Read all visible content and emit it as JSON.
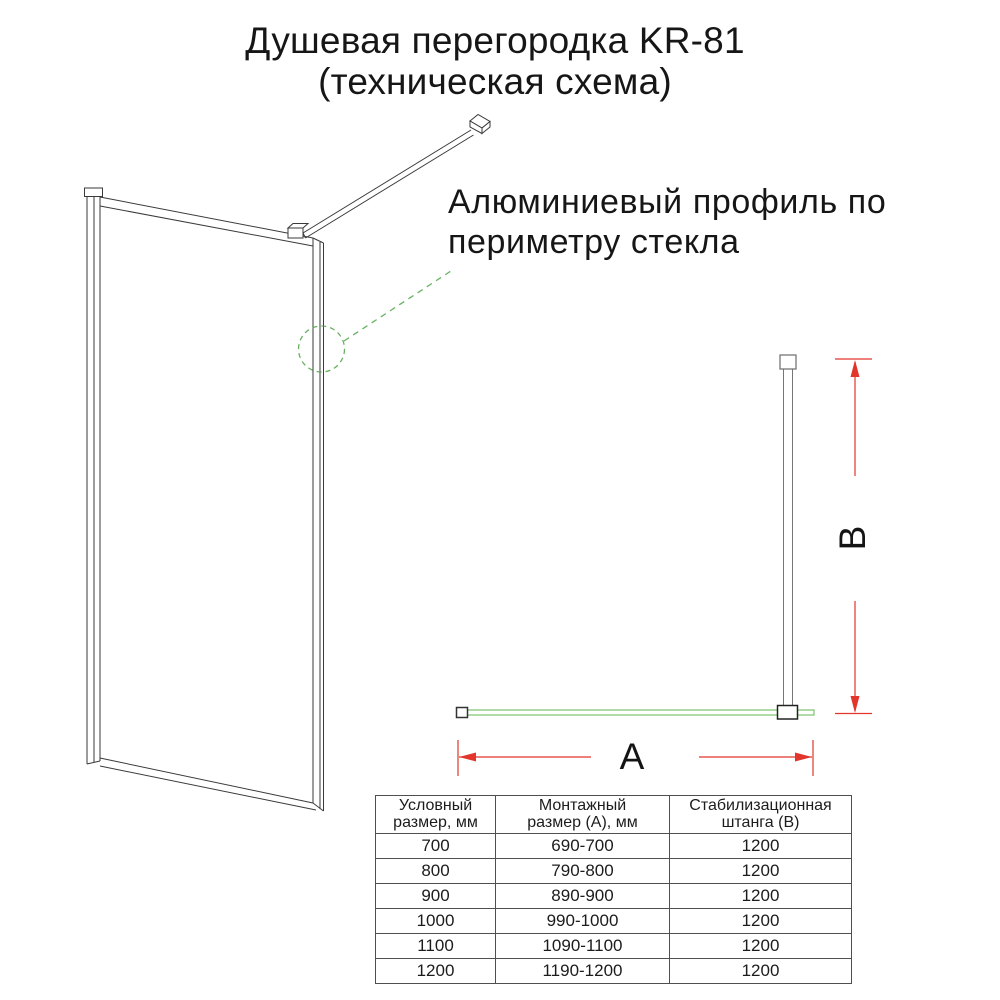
{
  "title": {
    "line1": "Душевая перегородка KR-81",
    "line2": "(техническая схема)"
  },
  "annotation": {
    "line1": "Алюминиевый профиль по",
    "line2": "периметру стекла"
  },
  "dimensions": {
    "width_label": "A",
    "height_label": "B"
  },
  "table": {
    "headers": [
      [
        "Условный",
        "размер, мм"
      ],
      [
        "Монтажный",
        "размер (А), мм"
      ],
      [
        "Стабилизационная",
        "штанга (B)"
      ]
    ],
    "rows": [
      [
        "700",
        "690-700",
        "1200"
      ],
      [
        "800",
        "790-800",
        "1200"
      ],
      [
        "900",
        "890-900",
        "1200"
      ],
      [
        "1000",
        "990-1000",
        "1200"
      ],
      [
        "1100",
        "1090-1100",
        "1200"
      ],
      [
        "1200",
        "1190-1200",
        "1200"
      ]
    ]
  },
  "colors": {
    "dimension_red": "#e2352b",
    "glass_green": "#7cc06a",
    "annotation_green": "#4ea446",
    "line_dark": "#3a3a3a",
    "text": "#1f1f1f"
  }
}
